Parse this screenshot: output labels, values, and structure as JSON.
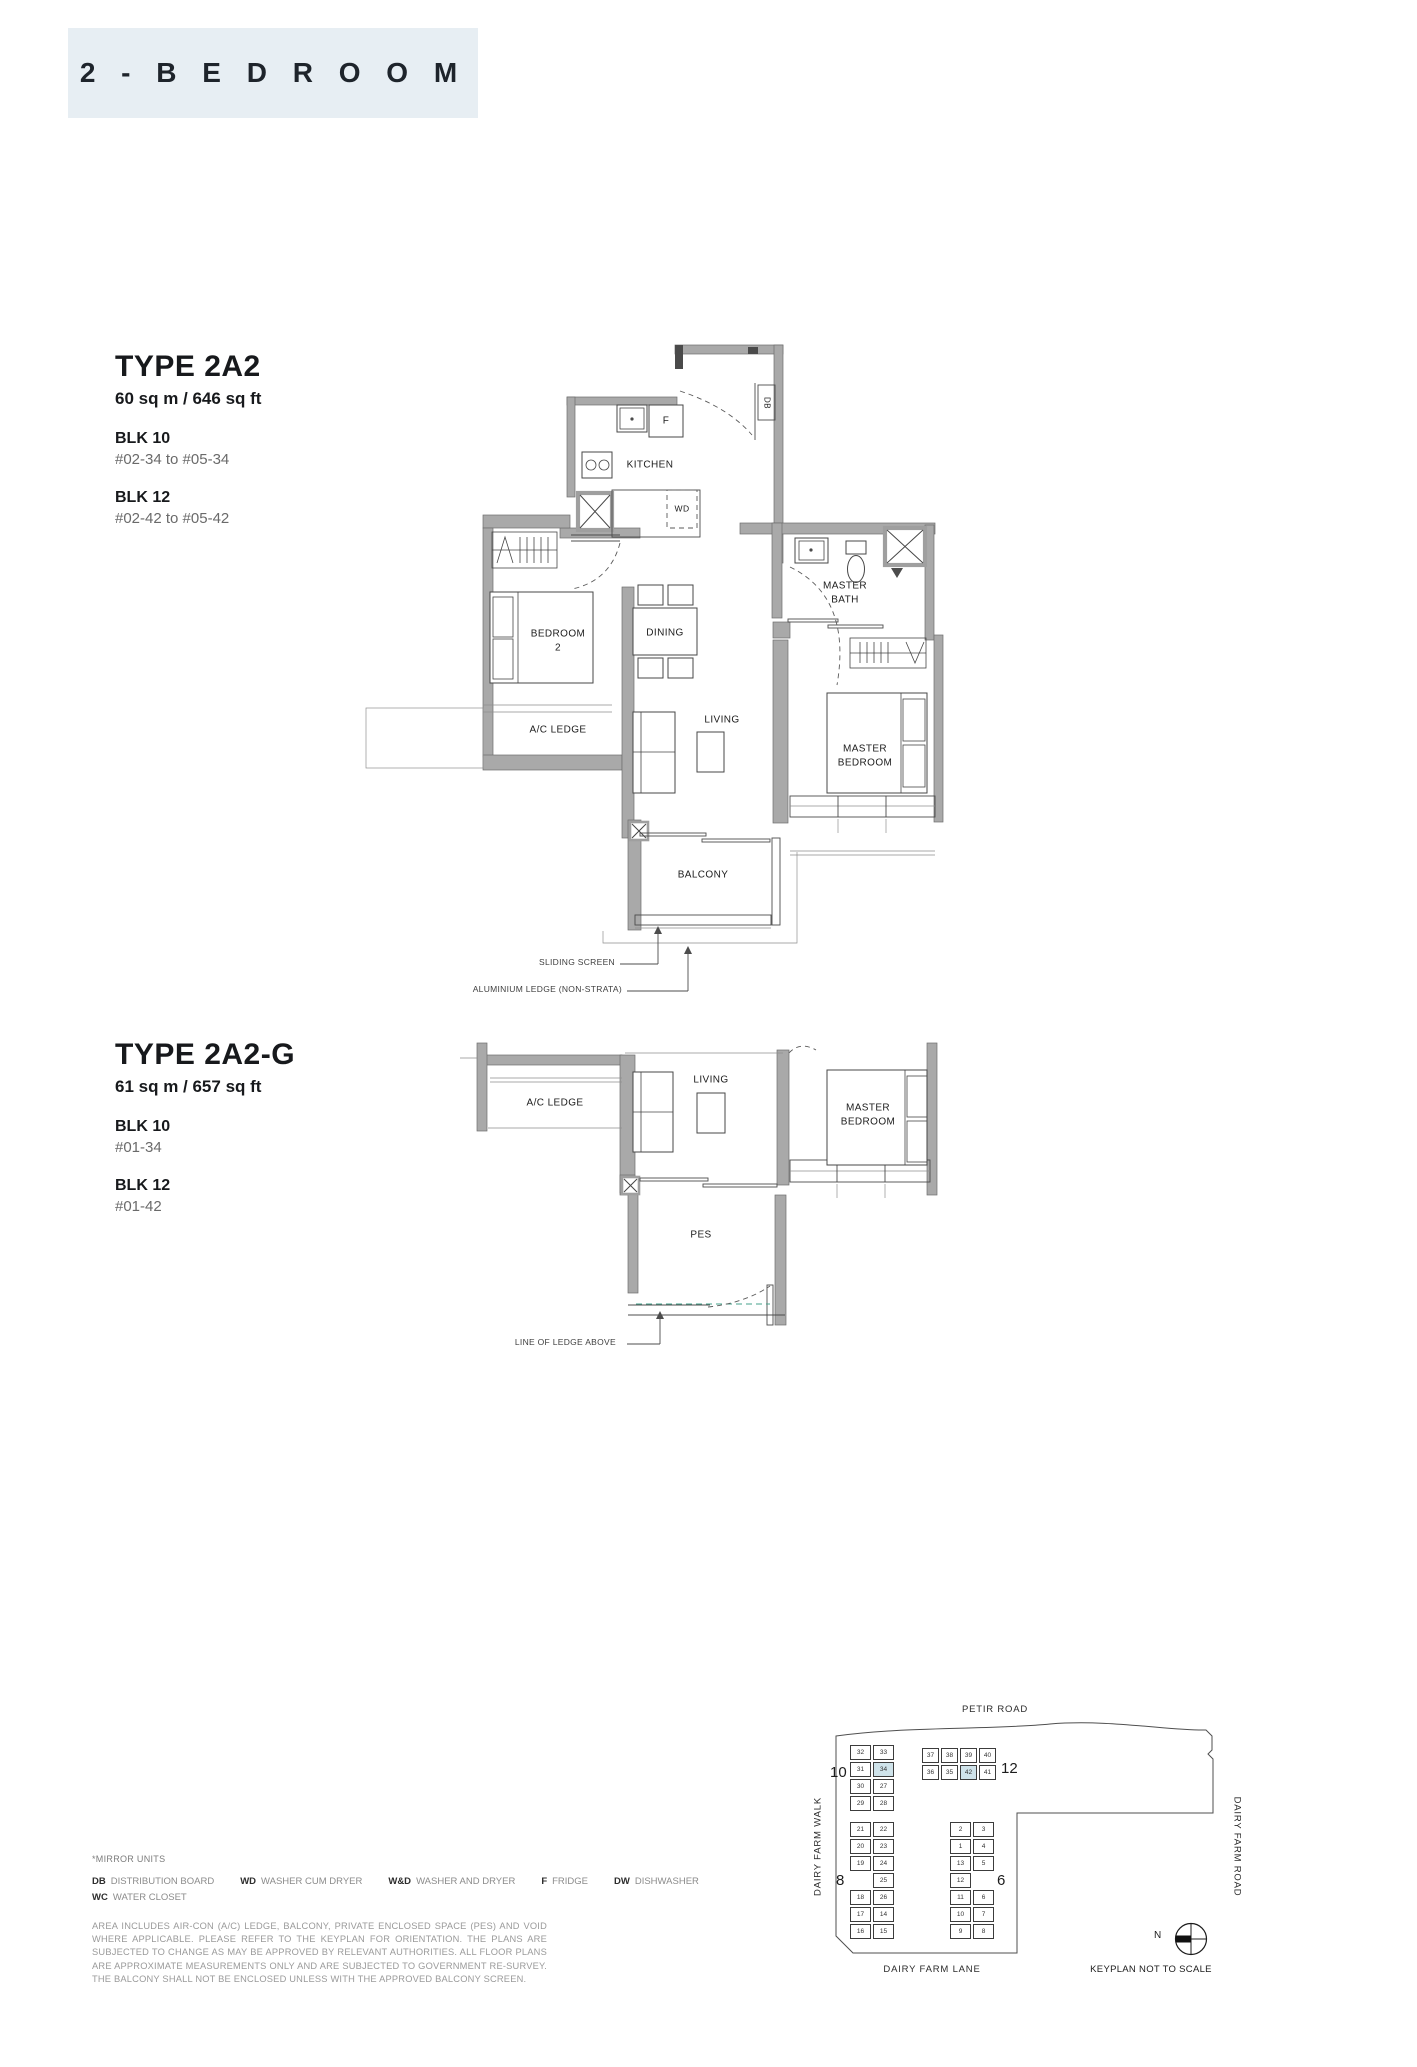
{
  "colors": {
    "header_bg": "#e7eef3",
    "wall_gray": "#a9a9a9",
    "keyplan_highlight": "#cfe3ea",
    "pes_ledge_line_green": "#46a28b"
  },
  "header": {
    "title": "2 - B E D R O O M"
  },
  "type_2a2": {
    "title": "TYPE 2A2",
    "area": "60 sq m / 646 sq ft",
    "blocks": [
      {
        "name": "BLK 10",
        "units": "#02-34 to #05-34"
      },
      {
        "name": "BLK 12",
        "units": "#02-42 to #05-42"
      }
    ],
    "labels": {
      "kitchen": "KITCHEN",
      "fridge": "F",
      "washer": "WD",
      "db": "DB",
      "bedroom2": "BEDROOM\n2",
      "dining": "DINING",
      "ac_ledge": "A/C LEDGE",
      "living": "LIVING",
      "master_bath": "MASTER\nBATH",
      "master_bedroom": "MASTER\nBEDROOM",
      "balcony": "BALCONY"
    },
    "annotations": {
      "sliding_screen": "SLIDING SCREEN",
      "aluminium_ledge": "ALUMINIUM LEDGE (NON-STRATA)"
    }
  },
  "type_2a2g": {
    "title": "TYPE 2A2-G",
    "area": "61 sq m / 657 sq ft",
    "blocks": [
      {
        "name": "BLK 10",
        "units": "#01-34"
      },
      {
        "name": "BLK 12",
        "units": "#01-42"
      }
    ],
    "labels": {
      "ac_ledge": "A/C LEDGE",
      "living": "LIVING",
      "master_bedroom": "MASTER\nBEDROOM",
      "pes": "PES"
    },
    "annotations": {
      "line_of_ledge": "LINE OF LEDGE ABOVE"
    }
  },
  "notes": {
    "mirror": "*MIRROR UNITS",
    "legend": [
      {
        "abbr": "DB",
        "label": "DISTRIBUTION BOARD"
      },
      {
        "abbr": "WD",
        "label": "WASHER CUM DRYER"
      },
      {
        "abbr": "W&D",
        "label": "WASHER AND DRYER"
      },
      {
        "abbr": "F",
        "label": "FRIDGE"
      },
      {
        "abbr": "DW",
        "label": "DISHWASHER"
      }
    ],
    "legend2": [
      {
        "abbr": "WC",
        "label": "WATER CLOSET"
      }
    ],
    "disclaimer": "AREA INCLUDES AIR-CON (A/C) LEDGE, BALCONY, PRIVATE ENCLOSED SPACE (PES) AND VOID WHERE APPLICABLE. PLEASE REFER TO THE KEYPLAN FOR ORIENTATION. THE PLANS ARE SUBJECTED TO CHANGE AS MAY BE APPROVED BY RELEVANT AUTHORITIES. ALL FLOOR PLANS ARE APPROXIMATE MEASUREMENTS ONLY AND ARE SUBJECTED TO GOVERNMENT RE-SURVEY. THE BALCONY SHALL NOT BE ENCLOSED UNLESS WITH THE APPROVED BALCONY SCREEN."
  },
  "keyplan": {
    "roads": {
      "top": "PETIR ROAD",
      "left": "DAIRY FARM WALK",
      "right": "DAIRY FARM ROAD",
      "bottom": "DAIRY FARM LANE"
    },
    "north_label": "N",
    "note": "KEYPLAN NOT TO SCALE",
    "blocks": [
      {
        "label": "10",
        "rows": [
          [
            "32",
            "33"
          ],
          [
            "31",
            "34"
          ],
          [
            "30",
            "27"
          ],
          [
            "29",
            "28"
          ]
        ],
        "highlight": [
          "34"
        ]
      },
      {
        "label": "12",
        "rows": [
          [
            "37",
            "38",
            "39",
            "40"
          ],
          [
            "36",
            "35",
            "42",
            "41"
          ]
        ],
        "highlight": [
          "42"
        ]
      },
      {
        "label": "8",
        "rows": [
          [
            "21",
            "22"
          ],
          [
            "20",
            "23"
          ],
          [
            "19",
            "24"
          ],
          [
            "",
            "25"
          ],
          [
            "18",
            "26"
          ],
          [
            "17",
            "14"
          ],
          [
            "16",
            "15"
          ]
        ],
        "highlight": []
      },
      {
        "label": "6",
        "rows": [
          [
            "2",
            "3"
          ],
          [
            "1",
            "4"
          ],
          [
            "13",
            "5"
          ],
          [
            "12",
            ""
          ],
          [
            "11",
            "6"
          ],
          [
            "10",
            "7"
          ],
          [
            "9",
            "8"
          ]
        ],
        "highlight": []
      }
    ]
  }
}
